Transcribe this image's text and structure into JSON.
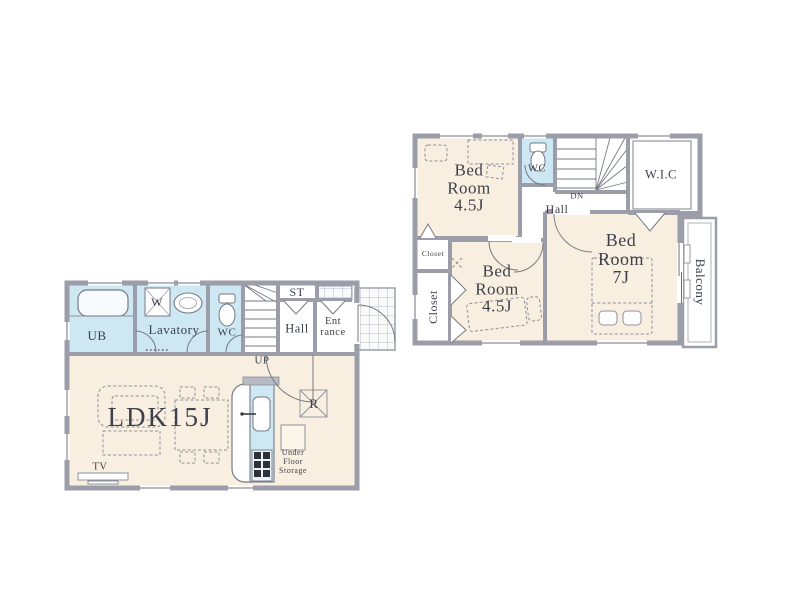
{
  "colors": {
    "room_fill": "#f9efe0",
    "wet_area_fill": "#cde7f3",
    "wall": "#9b9ea9",
    "thin_line": "#6e717c",
    "furniture_line": "#8d909b",
    "text": "#3e414b"
  },
  "floor1": {
    "labels": {
      "ub": "UB",
      "washer": "W",
      "lavatory": "Lavatory",
      "wc": "WC",
      "st": "ST",
      "hall": "Hall",
      "entrance": "Ent\nrance",
      "stairs_up": "UP",
      "ldk": "LDK15J",
      "refrigerator": "R",
      "under_floor_storage": "Under\nFloor\nStorage",
      "tv": "TV"
    }
  },
  "floor2": {
    "labels": {
      "bedroom_a": "Bed\nRoom\n4.5J",
      "wc": "WC",
      "stairs_dn": "DN",
      "hall": "Hall",
      "wic": "W.I.C",
      "closet_small": "Closet",
      "closet_tall": "Closet",
      "bedroom_b": "Bed\nRoom\n4.5J",
      "bedroom_c": "Bed\nRoom\n7J",
      "balcony": "Balcony"
    }
  }
}
